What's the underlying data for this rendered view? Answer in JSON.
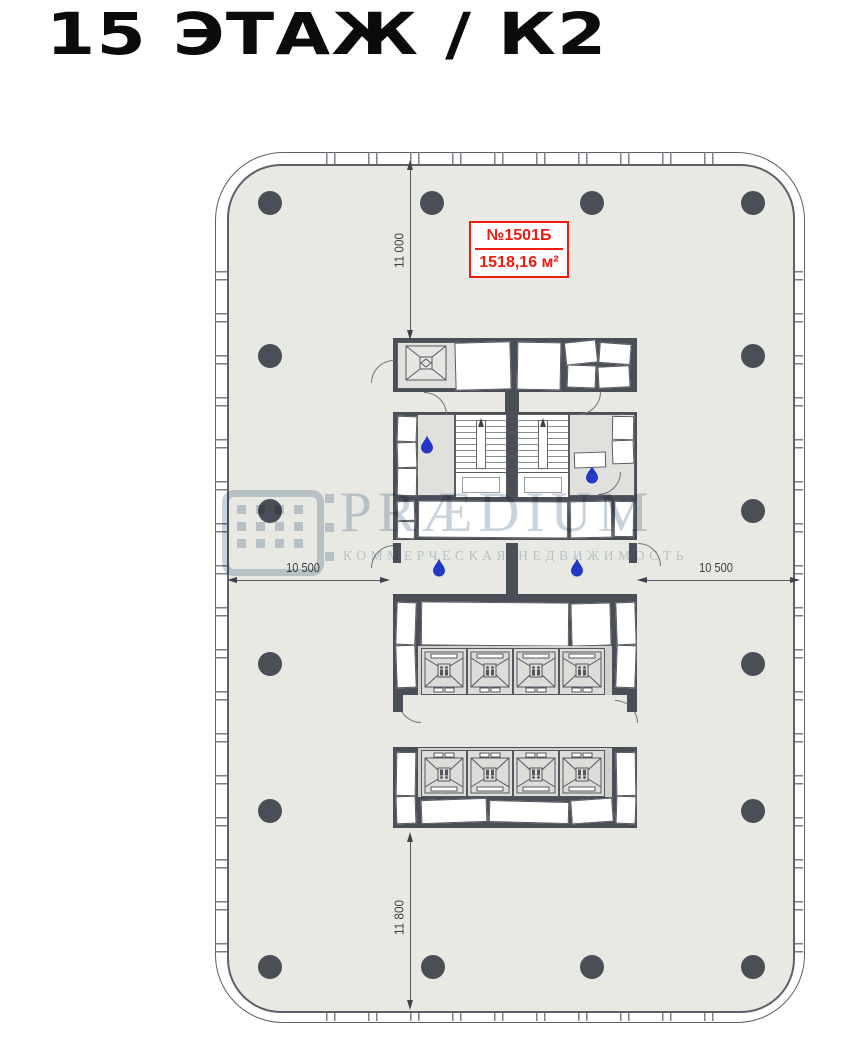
{
  "page": {
    "title": "15 ЭТАЖ / К2"
  },
  "unit_label": {
    "number": "№1501Б",
    "area": "1518,16 м²"
  },
  "dimensions": {
    "top": "11 000",
    "bottom": "11 800",
    "left": "10 500",
    "right": "10 500"
  },
  "watermark": {
    "brand": "PRÆDIUM",
    "tagline": "КОММЕРЧЕСКАЯ НЕДВИЖИМОСТЬ"
  },
  "colors": {
    "floor": "#e9e9e4",
    "wall": "#4a4e57",
    "accent_red": "#ef1a10",
    "water_blue": "#2438c8",
    "watermark_blue": "#c9d3dd",
    "dim_line": "#55585e"
  },
  "plan": {
    "columns": [
      [
        270,
        203
      ],
      [
        432,
        203
      ],
      [
        592,
        203
      ],
      [
        753,
        203
      ],
      [
        270,
        356
      ],
      [
        753,
        356
      ],
      [
        270,
        511
      ],
      [
        753,
        511
      ],
      [
        270,
        664
      ],
      [
        753,
        664
      ],
      [
        270,
        811
      ],
      [
        753,
        811
      ],
      [
        270,
        967
      ],
      [
        433,
        967
      ],
      [
        592,
        967
      ],
      [
        753,
        967
      ]
    ],
    "wet_points": [
      [
        427,
        444
      ],
      [
        592,
        474
      ],
      [
        439,
        567
      ],
      [
        577,
        567
      ]
    ],
    "elevator_xs": [
      421,
      467,
      513,
      559
    ],
    "elevator_banks": [
      {
        "y": 648,
        "doors": "down",
        "count": 4
      },
      {
        "y": 750,
        "doors": "up",
        "count": 4
      }
    ]
  }
}
